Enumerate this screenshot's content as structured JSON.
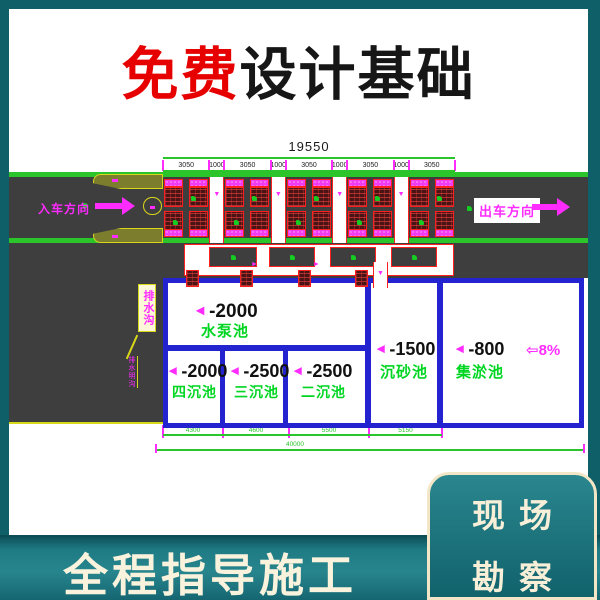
{
  "title": {
    "highlight": "免费",
    "rest": "设计基础"
  },
  "banner": {
    "text": "全程指导施工"
  },
  "badge": {
    "line1": "现场",
    "line2": "勘察"
  },
  "drawing": {
    "top_dim": {
      "total": "19550",
      "segments": [
        "3050",
        "1000",
        "3050",
        "1000",
        "3050",
        "1000",
        "3050",
        "1000",
        "3050"
      ]
    },
    "bottom_dim": {
      "segments": [
        "4300",
        "4600",
        "5500",
        "5150"
      ],
      "total": "40000"
    },
    "entry_label": "入车方向",
    "exit_label": "出车方向",
    "slope_value": "8%",
    "note_box": "排水沟",
    "note_leader": "排水明沟",
    "pools": {
      "pump": {
        "depth": "-2000",
        "name": "水泵池"
      },
      "four": {
        "depth": "-2000",
        "name": "四沉池"
      },
      "three": {
        "depth": "-2500",
        "name": "三沉池"
      },
      "two": {
        "depth": "-2500",
        "name": "二沉池"
      },
      "grit": {
        "depth": "-1500",
        "name": "沉砂池"
      },
      "sludge": {
        "depth": "-800",
        "name": "集淤池"
      }
    }
  },
  "colors": {
    "teal_background": "#0f5f68",
    "accent_red": "#e60000",
    "cad_magenta": "#ff2bff",
    "cad_green": "#2bc52b",
    "pool_name_green": "#00d622",
    "wall_blue": "#2323cf",
    "road_gray": "#3e3e3e",
    "brick_red": "#4a1414",
    "curb_yellow": "#d8d81a",
    "cream_text": "#f8efd8"
  }
}
